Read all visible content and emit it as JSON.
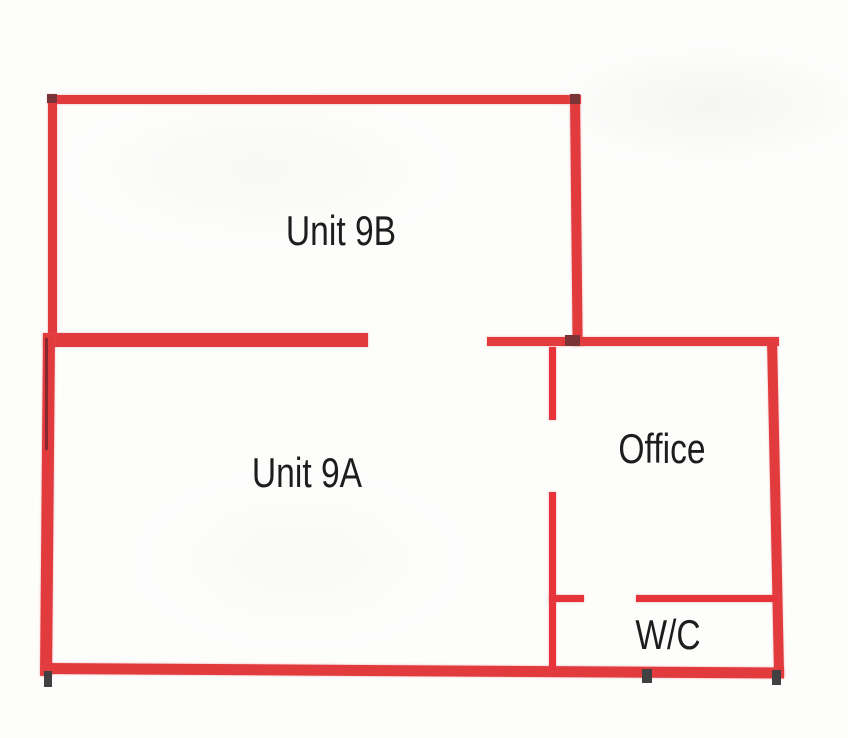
{
  "plan": {
    "name": "floor-plan",
    "width": 848,
    "height": 738,
    "background": "#fdfdfc"
  },
  "colors": {
    "outer_wall_red": "#e23b3e",
    "interior_wall_red": "#e7343a",
    "dark_red_mark": "#7a3337",
    "dark_tick": "#414143",
    "dark_line": "rgba(60,30,34,0.55)",
    "label_text": "#1d1d1d"
  },
  "rooms": [
    {
      "id": "unit-9b",
      "label": "Unit 9B",
      "cx": 341,
      "cy": 231
    },
    {
      "id": "unit-9a",
      "label": "Unit 9A",
      "cx": 307,
      "cy": 473
    },
    {
      "id": "office",
      "label": "Office",
      "cx": 662,
      "cy": 449
    },
    {
      "id": "wc",
      "label": "W/C",
      "cx": 668,
      "cy": 635
    }
  ],
  "walls": [
    {
      "name": "unit9b-wall-top",
      "x": 48,
      "y": 95,
      "w": 533,
      "h": 9,
      "color": "outer_wall_red"
    },
    {
      "name": "unit9b-wall-left",
      "x": 48,
      "y": 95,
      "w": 9,
      "h": 246,
      "color": "outer_wall_red"
    },
    {
      "name": "unit9b-wall-right",
      "x": 570,
      "y": 95,
      "w": 10,
      "h": 251,
      "color": "outer_wall_red",
      "rot": -0.6,
      "origin": "top"
    },
    {
      "name": "divider-9a-9b-wall",
      "x": 43,
      "y": 333,
      "w": 325,
      "h": 14,
      "color": "outer_wall_red"
    },
    {
      "name": "office-wall-top",
      "x": 487,
      "y": 337,
      "w": 292,
      "h": 9,
      "color": "outer_wall_red"
    },
    {
      "name": "unit9a-wall-left",
      "x": 43,
      "y": 335,
      "w": 12,
      "h": 341,
      "color": "outer_wall_red",
      "rot": 0.5,
      "origin": "top"
    },
    {
      "name": "bottom-wall",
      "x": 43,
      "y": 663,
      "w": 741,
      "h": 11,
      "color": "outer_wall_red",
      "rot": 0.35,
      "origin": "left"
    },
    {
      "name": "office-wall-right",
      "x": 767,
      "y": 338,
      "w": 10,
      "h": 339,
      "color": "outer_wall_red",
      "rot": -1.2,
      "origin": "top"
    },
    {
      "name": "interior-wall-office-upper",
      "x": 549,
      "y": 347,
      "w": 7,
      "h": 73,
      "color": "interior_wall_red"
    },
    {
      "name": "interior-wall-office-lower",
      "x": 549,
      "y": 492,
      "w": 7,
      "h": 178,
      "color": "interior_wall_red"
    },
    {
      "name": "interior-wall-wc-stub",
      "x": 549,
      "y": 595,
      "w": 35,
      "h": 7,
      "color": "interior_wall_red"
    },
    {
      "name": "interior-wall-wc-right",
      "x": 636,
      "y": 595,
      "w": 142,
      "h": 7,
      "color": "interior_wall_red"
    }
  ],
  "marks": [
    {
      "name": "mark-corner-9b-topleft",
      "x": 47,
      "y": 94,
      "w": 10,
      "h": 9,
      "color": "dark_red_mark"
    },
    {
      "name": "mark-corner-9b-topright",
      "x": 570,
      "y": 94,
      "w": 10,
      "h": 10,
      "color": "dark_red_mark"
    },
    {
      "name": "mark-junction-9b-right",
      "x": 565,
      "y": 335,
      "w": 15,
      "h": 11,
      "color": "dark_red_mark"
    },
    {
      "name": "mark-left-wall-line",
      "x": 45,
      "y": 338,
      "w": 3,
      "h": 112,
      "color": "dark_line"
    },
    {
      "name": "tick-bottom-left",
      "x": 44,
      "y": 671,
      "w": 8,
      "h": 16,
      "color": "dark_tick"
    },
    {
      "name": "tick-bottom-middle",
      "x": 642,
      "y": 669,
      "w": 10,
      "h": 14,
      "color": "dark_tick"
    },
    {
      "name": "tick-bottom-right",
      "x": 772,
      "y": 670,
      "w": 9,
      "h": 15,
      "color": "dark_tick"
    }
  ]
}
